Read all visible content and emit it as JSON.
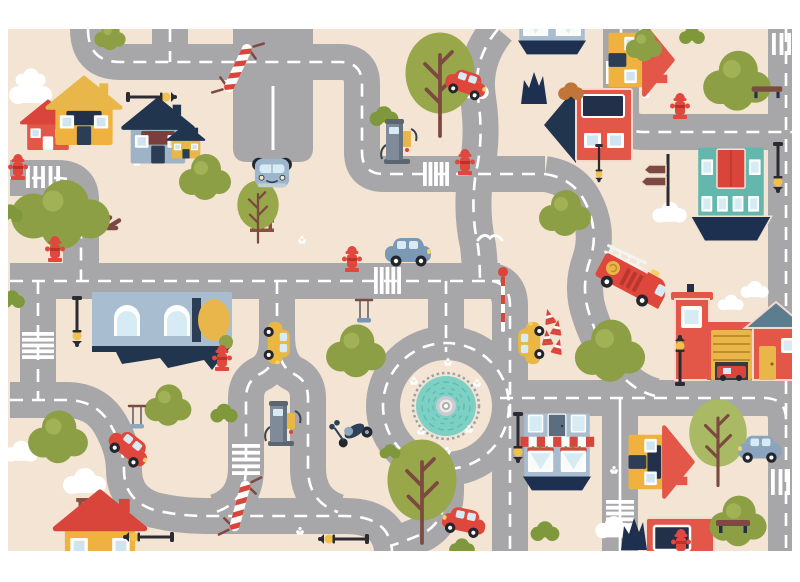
{
  "canvas": {
    "width": 800,
    "height": 582
  },
  "mat": {
    "x": 8,
    "y": 29,
    "width": 784,
    "height": 522
  },
  "palette": {
    "page_bg": "#ffffff",
    "mat_bg": "#f3e4d3",
    "road": "#a7a7aa",
    "road_line": "#ffffff",
    "navy": "#1e3050",
    "red": "#e25747",
    "bright_red": "#d9453a",
    "yellow": "#e9b64a",
    "teal": "#63b7ad",
    "pool_teal": "#7ed0c5",
    "olive": "#8c9f45",
    "light_olive": "#a0b156",
    "bush_green": "#7f983b",
    "branch_brown": "#7d4a41",
    "slate_blue": "#a9bdd0",
    "slate_roof": "#5b7d8e",
    "lamp_black": "#2b2b33",
    "cloud_white": "#ffffff"
  },
  "road_style": {
    "width": 36,
    "line_width": 2.6,
    "dash": "13 9"
  },
  "roads": [
    {
      "name": "topleft-cross",
      "d": "M88,29 Q88,62 120,62 H340 Q362,62 362,84 V152 Q362,174 384,174 H545",
      "line": "dash"
    },
    {
      "name": "topleft-stub",
      "d": "M170,29 V62",
      "line": "dash"
    },
    {
      "name": "s-curve-top",
      "d": "M498,29 Q472,60 478,98 Q484,138 476,172 Q470,210 478,246 Q480,262 480,281",
      "line": "dash"
    },
    {
      "name": "topright",
      "d": "M621,29 V110 Q621,132 643,132 H792",
      "line": "dash"
    },
    {
      "name": "right-edge",
      "d": "M786,29 V551",
      "line": "dash"
    },
    {
      "name": "main-mid",
      "d": "M10,281 H500",
      "line": "dash"
    },
    {
      "name": "taxi-right",
      "d": "M492,281 Q510,284 510,306 V551",
      "line": "dash"
    },
    {
      "name": "left-upper",
      "d": "M10,178 H58 Q81,178 81,200 V281",
      "line": "dash"
    },
    {
      "name": "left-lower",
      "d": "M38,281 V400",
      "line": "dash"
    },
    {
      "name": "bottom-left",
      "d": "M10,400 H66 Q96,400 110,424 Q124,448 124,470 Q124,500 154,510 Q180,516 205,516 H345 Q375,516 386,532 Q392,542 392,551",
      "line": "dash"
    },
    {
      "name": "loop-a",
      "d": "M277,281 V338 Q277,366 260,374 Q246,381 246,398 V468 Q246,502 216,512",
      "line": "dash"
    },
    {
      "name": "loop-b",
      "d": "M277,335 Q277,366 294,374 Q308,381 308,398 V468 Q308,502 338,512",
      "line": "dash"
    },
    {
      "name": "ring-north",
      "d": "M446,281 V352",
      "line": "dash"
    },
    {
      "name": "ring-south",
      "d": "M446,458 V490 Q446,520 424,533 Q406,541 390,546",
      "line": "dash"
    },
    {
      "name": "bottom-right",
      "d": "M500,398 H764 Q786,398 786,420",
      "line": "dash"
    },
    {
      "name": "bottom-right-v",
      "d": "M620,398 V551",
      "line": "solid"
    },
    {
      "name": "fire-curve",
      "d": "M545,174 Q572,178 584,200 Q600,230 590,260 Q580,288 590,316 Q600,346 617,370 Q632,390 655,396",
      "line": "dash"
    }
  ],
  "parking": {
    "name": "parking-area",
    "d": "M233,29 V148 Q233,162 247,162 H299 Q313,162 313,148 V29 Z",
    "line_d": "M273,86 V150"
  },
  "roundabout": {
    "cx": 446,
    "cy": 406,
    "ring_radius": 63,
    "ring_width": 34,
    "island_radius": 44,
    "tick_radius": 33,
    "pool_radius": 30,
    "pool_color": "#7ed0c5",
    "mosaic_color": "#58bfb0",
    "tick_color": "#9ba1a6",
    "hub_colors": [
      "#c7ccd1",
      "#efe9e1",
      "#a8aeb4",
      "#ffffff"
    ]
  },
  "crosswalks": [
    {
      "x": 26,
      "y": 166,
      "w": 34,
      "h": 22,
      "o": "v",
      "n": 5
    },
    {
      "x": 423,
      "y": 162,
      "w": 26,
      "h": 24,
      "o": "v",
      "n": 5
    },
    {
      "x": 374,
      "y": 267,
      "w": 27,
      "h": 27,
      "o": "v",
      "n": 5
    },
    {
      "x": 606,
      "y": 61,
      "w": 30,
      "h": 23,
      "o": "v",
      "n": 6
    },
    {
      "x": 772,
      "y": 33,
      "w": 19,
      "h": 22,
      "o": "v",
      "n": 3
    },
    {
      "x": 771,
      "y": 469,
      "w": 19,
      "h": 26,
      "o": "v",
      "n": 3
    },
    {
      "x": 606,
      "y": 500,
      "w": 28,
      "h": 27,
      "o": "h",
      "n": 5
    },
    {
      "x": 232,
      "y": 444,
      "w": 28,
      "h": 31,
      "o": "h",
      "n": 5
    },
    {
      "x": 22,
      "y": 332,
      "w": 32,
      "h": 27,
      "o": "h",
      "n": 5
    }
  ],
  "items": [
    {
      "t": "cloud",
      "n": "cloud",
      "x": 31,
      "y": 92,
      "s": 1.0
    },
    {
      "t": "cloud",
      "n": "cloud",
      "x": 31,
      "y": 78,
      "s": 0.7
    },
    {
      "t": "cloud",
      "n": "cloud",
      "x": 473,
      "y": 90,
      "s": 0.75
    },
    {
      "t": "cloud",
      "n": "cloud",
      "x": 670,
      "y": 213,
      "s": 0.8
    },
    {
      "t": "cloud",
      "n": "cloud",
      "x": 755,
      "y": 290,
      "s": 0.65
    },
    {
      "t": "cloud",
      "n": "cloud",
      "x": 85,
      "y": 482,
      "s": 1.0
    },
    {
      "t": "cloud",
      "n": "cloud",
      "x": 21,
      "y": 452,
      "s": 0.8
    },
    {
      "t": "cloud",
      "n": "cloud",
      "x": 614,
      "y": 528,
      "s": 0.85
    },
    {
      "t": "cloud",
      "n": "cloud",
      "x": 731,
      "y": 303,
      "s": 0.6
    },
    {
      "t": "flower",
      "n": "flower",
      "x": 612,
      "y": 72,
      "s": 1
    },
    {
      "t": "flower",
      "n": "flower",
      "x": 646,
      "y": 94,
      "s": 1
    },
    {
      "t": "flower",
      "n": "flower",
      "x": 302,
      "y": 240,
      "s": 1
    },
    {
      "t": "flower",
      "n": "flower",
      "x": 137,
      "y": 162,
      "s": 1
    },
    {
      "t": "flower",
      "n": "flower",
      "x": 614,
      "y": 470,
      "s": 1
    },
    {
      "t": "flower",
      "n": "flower",
      "x": 300,
      "y": 531,
      "s": 1
    },
    {
      "t": "flower",
      "n": "flower",
      "x": 160,
      "y": 318,
      "s": 1
    },
    {
      "t": "flower",
      "n": "flower",
      "x": 712,
      "y": 95,
      "s": 1
    },
    {
      "t": "flower",
      "n": "flower",
      "x": 448,
      "y": 362,
      "s": 1
    },
    {
      "t": "flower",
      "n": "flower",
      "x": 414,
      "y": 381,
      "s": 1
    },
    {
      "t": "flower",
      "n": "flower",
      "x": 477,
      "y": 383,
      "s": 1
    },
    {
      "t": "flower",
      "n": "flower",
      "x": 421,
      "y": 431,
      "s": 1
    },
    {
      "t": "flower",
      "n": "flower",
      "x": 469,
      "y": 429,
      "s": 1
    },
    {
      "t": "flower",
      "n": "flower",
      "x": 447,
      "y": 451,
      "s": 1
    },
    {
      "t": "bird",
      "n": "seagull",
      "x": 490,
      "y": 237,
      "s": 1
    },
    {
      "t": "fence",
      "n": "fence",
      "x": 262,
      "y": 212,
      "s": 1,
      "r": 90
    },
    {
      "t": "fence",
      "n": "fence",
      "x": 118,
      "y": 304,
      "s": 0.9
    },
    {
      "t": "fence",
      "n": "fence",
      "x": 90,
      "y": 521,
      "s": 1.15,
      "r": 90
    },
    {
      "t": "house",
      "n": "house-annex-red",
      "x": 48,
      "y": 126,
      "s": 0.8,
      "c": {
        "wall": "#e25747",
        "roof": "#d9453a",
        "door": "#fdfdfb"
      }
    },
    {
      "t": "house",
      "n": "house-yellow",
      "x": 84,
      "y": 112,
      "s": 1.1,
      "c": {
        "wall": "#efb23e",
        "roof": "#e9b64a",
        "band": "#22304a"
      }
    },
    {
      "t": "house",
      "n": "house-blue",
      "x": 158,
      "y": 132,
      "s": 1.05,
      "c": {
        "wall": "#9db3c6",
        "roof": "#22354f",
        "band": "#7a3f3a"
      }
    },
    {
      "t": "house",
      "n": "house-yellow-small",
      "x": 186,
      "y": 142,
      "s": 0.55,
      "c": {
        "wall": "#e9b64a",
        "roof": "#22354f"
      }
    },
    {
      "t": "bighouse",
      "n": "house-flipped-blue",
      "x": 162,
      "y": 330,
      "s": 1.0
    },
    {
      "t": "redbuilding",
      "n": "building-red",
      "x": 588,
      "y": 125,
      "s": 1.0
    },
    {
      "t": "dogjag",
      "n": "hedge-silhouette",
      "x": 534,
      "y": 88,
      "s": 1.0
    },
    {
      "t": "house",
      "n": "house-yellow-rotated",
      "x": 640,
      "y": 60,
      "s": 1.05,
      "r": 90,
      "c": {
        "wall": "#efb23e",
        "roof": "#e25747"
      }
    },
    {
      "t": "tealbuilding",
      "n": "building-teal-boat",
      "x": 731,
      "y": 196,
      "s": 0.78
    },
    {
      "t": "firestation",
      "n": "fire-station",
      "x": 737,
      "y": 332,
      "s": 1.0
    },
    {
      "t": "cafe",
      "n": "cafe-shop",
      "x": 557,
      "y": 450,
      "s": 0.63
    },
    {
      "t": "cafe",
      "n": "cafe-shop-top-cut",
      "x": 552,
      "y": 14,
      "s": 0.63
    },
    {
      "t": "house",
      "n": "house-yellow-bottom-cut",
      "x": 100,
      "y": 534,
      "s": 1.35,
      "c": {
        "wall": "#efb23e",
        "roof": "#d9453a"
      }
    },
    {
      "t": "house",
      "n": "house-yellow-right",
      "x": 660,
      "y": 462,
      "s": 1.05,
      "r": 90,
      "c": {
        "wall": "#efb23e",
        "roof": "#e25747",
        "band": "#22304a"
      }
    },
    {
      "t": "redshop",
      "n": "shop-red-bottom-cut",
      "x": 680,
      "y": 540,
      "s": 1.0
    },
    {
      "t": "dogjag",
      "n": "hedge-silhouette",
      "x": 634,
      "y": 534,
      "s": 1.0
    },
    {
      "t": "tree2",
      "n": "tree-branch",
      "x": 440,
      "y": 85,
      "s": 1.5
    },
    {
      "t": "tree1",
      "n": "tree-fluffy",
      "x": 110,
      "y": 37,
      "s": 0.6
    },
    {
      "t": "tree1",
      "n": "tree-fluffy",
      "x": 205,
      "y": 178,
      "s": 1.0
    },
    {
      "t": "tree1",
      "n": "tree-fluffy",
      "x": 737,
      "y": 82,
      "s": 1.3
    },
    {
      "t": "tree1",
      "n": "tree-fluffy",
      "x": 644,
      "y": 46,
      "s": 0.7
    },
    {
      "t": "tree1",
      "n": "tree-fluffy",
      "x": 565,
      "y": 214,
      "s": 1.0
    },
    {
      "t": "tree1",
      "n": "tree-fluffy",
      "x": 610,
      "y": 352,
      "s": 1.35
    },
    {
      "t": "tree1",
      "n": "tree-fluffy",
      "x": 356,
      "y": 352,
      "s": 1.15
    },
    {
      "t": "tree1",
      "n": "tree-fluffy",
      "x": 58,
      "y": 438,
      "s": 1.15
    },
    {
      "t": "tree1",
      "n": "tree-fluffy",
      "x": 168,
      "y": 406,
      "s": 0.9
    },
    {
      "t": "tree1",
      "n": "tree-fluffy",
      "x": 738,
      "y": 522,
      "s": 1.1
    },
    {
      "t": "tree2",
      "n": "tree-branch",
      "x": 258,
      "y": 212,
      "s": 0.9
    },
    {
      "t": "tree2",
      "n": "tree-branch",
      "x": 422,
      "y": 492,
      "s": 1.5
    },
    {
      "t": "tree2",
      "n": "tree-branch-light",
      "x": 718,
      "y": 443,
      "s": 1.25,
      "c": {
        "g": "#a9b964"
      }
    },
    {
      "t": "tree3",
      "n": "tree-wide-branch",
      "x": 62,
      "y": 222,
      "s": 1.5
    },
    {
      "t": "bush",
      "n": "bush",
      "x": 384,
      "y": 117,
      "s": 0.9
    },
    {
      "t": "bush",
      "n": "bush",
      "x": 12,
      "y": 300,
      "s": 0.8
    },
    {
      "t": "bush",
      "n": "bush",
      "x": 10,
      "y": 214,
      "s": 0.8
    },
    {
      "t": "bush",
      "n": "bush",
      "x": 224,
      "y": 414,
      "s": 0.85
    },
    {
      "t": "bush",
      "n": "bush",
      "x": 390,
      "y": 452,
      "s": 0.65
    },
    {
      "t": "bush",
      "n": "bush",
      "x": 545,
      "y": 532,
      "s": 0.9
    },
    {
      "t": "bush",
      "n": "bush",
      "x": 692,
      "y": 36,
      "s": 0.8
    },
    {
      "t": "bush",
      "n": "bush-orange",
      "x": 571,
      "y": 92,
      "s": 0.8,
      "c": {
        "g": "#c0763a"
      }
    },
    {
      "t": "bush",
      "n": "bush",
      "x": 462,
      "y": 548,
      "s": 0.8
    },
    {
      "t": "signpost",
      "n": "direction-signpost",
      "x": 668,
      "y": 180,
      "s": 1
    },
    {
      "t": "bench",
      "n": "bench",
      "x": 767,
      "y": 90,
      "s": 0.9
    },
    {
      "t": "bench",
      "n": "bench",
      "x": 733,
      "y": 524,
      "s": 1.0
    },
    {
      "t": "hydrant",
      "n": "fire-hydrant",
      "x": 18,
      "y": 167,
      "s": 1
    },
    {
      "t": "hydrant",
      "n": "fire-hydrant",
      "x": 55,
      "y": 249,
      "s": 1
    },
    {
      "t": "hydrant",
      "n": "fire-hydrant",
      "x": 352,
      "y": 259,
      "s": 1
    },
    {
      "t": "hydrant",
      "n": "fire-hydrant",
      "x": 465,
      "y": 162,
      "s": 1
    },
    {
      "t": "hydrant",
      "n": "fire-hydrant",
      "x": 680,
      "y": 106,
      "s": 1
    },
    {
      "t": "hydrant",
      "n": "fire-hydrant",
      "x": 222,
      "y": 358,
      "s": 1
    },
    {
      "t": "hydrant",
      "n": "fire-hydrant",
      "x": 681,
      "y": 542,
      "s": 1
    },
    {
      "t": "lamp",
      "n": "street-lamp",
      "x": 150,
      "y": 97,
      "s": 1,
      "r": 90
    },
    {
      "t": "lamp",
      "n": "street-lamp-hanging",
      "x": 77,
      "y": 320,
      "s": 1,
      "r": 180
    },
    {
      "t": "lamp",
      "n": "street-lamp",
      "x": 680,
      "y": 362,
      "s": 1
    },
    {
      "t": "lamp",
      "n": "street-lamp-hanging",
      "x": 518,
      "y": 436,
      "s": 1,
      "r": 180
    },
    {
      "t": "lamp",
      "n": "street-lamp-hanging",
      "x": 778,
      "y": 166,
      "s": 1,
      "r": 180
    },
    {
      "t": "lamp",
      "n": "street-lamp",
      "x": 150,
      "y": 537,
      "s": 1,
      "r": -90
    },
    {
      "t": "lamp",
      "n": "street-lamp",
      "x": 345,
      "y": 539,
      "s": 1,
      "r": -90
    },
    {
      "t": "lamp",
      "n": "street-lamp-hanging",
      "x": 599,
      "y": 162,
      "s": 0.75,
      "r": 180
    },
    {
      "t": "stripedpole",
      "n": "striped-barrier-pole",
      "x": 238,
      "y": 68,
      "s": 1,
      "r": 25
    },
    {
      "t": "stripedpole",
      "n": "striped-barrier-pole",
      "x": 240,
      "y": 506,
      "s": 1,
      "r": 15
    },
    {
      "t": "polered",
      "n": "striped-signal-pole",
      "x": 503,
      "y": 300,
      "s": 1
    },
    {
      "t": "cone",
      "n": "traffic-cone",
      "x": 549,
      "y": 316,
      "s": 0.8,
      "r": -15
    },
    {
      "t": "cone",
      "n": "traffic-cone",
      "x": 557,
      "y": 327,
      "s": 0.8,
      "r": 10
    },
    {
      "t": "cone",
      "n": "traffic-cone",
      "x": 547,
      "y": 337,
      "s": 0.8,
      "r": -5
    },
    {
      "t": "cone",
      "n": "traffic-cone",
      "x": 558,
      "y": 346,
      "s": 0.8,
      "r": 15
    },
    {
      "t": "swing",
      "n": "tree-swing",
      "x": 364,
      "y": 316,
      "s": 1
    },
    {
      "t": "swing",
      "n": "tree-swing",
      "x": 137,
      "y": 422,
      "s": 1,
      "c": {
        "seat": "#8fa7bc"
      }
    },
    {
      "t": "gaspump",
      "n": "gas-pump",
      "x": 397,
      "y": 141,
      "s": 1
    },
    {
      "t": "gaspump",
      "n": "gas-pump",
      "x": 281,
      "y": 423,
      "s": 1
    },
    {
      "t": "car",
      "n": "car-red",
      "x": 466,
      "y": 84,
      "s": 0.9,
      "r": 18,
      "c": {
        "body": "#e0473c"
      }
    },
    {
      "t": "carfront",
      "n": "car-blue-front-view",
      "x": 272,
      "y": 172,
      "s": 0.95
    },
    {
      "t": "car",
      "n": "car-blue",
      "x": 408,
      "y": 252,
      "s": 1.0,
      "c": {
        "body": "#7b98b5"
      }
    },
    {
      "t": "car",
      "n": "taxi-yellow",
      "x": 277,
      "y": 343,
      "s": 0.92,
      "r": 90,
      "c": {
        "body": "#eab743"
      }
    },
    {
      "t": "car",
      "n": "taxi-yellow",
      "x": 531,
      "y": 343,
      "s": 0.92,
      "r": -90,
      "c": {
        "body": "#eab743"
      }
    },
    {
      "t": "car",
      "n": "car-red",
      "x": 129,
      "y": 448,
      "s": 0.95,
      "r": 38,
      "c": {
        "body": "#e0473c"
      }
    },
    {
      "t": "car",
      "n": "car-red",
      "x": 464,
      "y": 522,
      "s": 0.95,
      "r": 12,
      "fx": true,
      "c": {
        "body": "#e0473c"
      }
    },
    {
      "t": "car",
      "n": "car-gray",
      "x": 760,
      "y": 449,
      "s": 0.95,
      "fx": true,
      "c": {
        "body": "#8aa4bd"
      }
    },
    {
      "t": "firetruck",
      "n": "fire-truck",
      "x": 632,
      "y": 277,
      "s": 1.0,
      "r": 28
    },
    {
      "t": "scooter",
      "n": "scooter",
      "x": 352,
      "y": 429,
      "s": 1.0,
      "r": -20
    }
  ]
}
